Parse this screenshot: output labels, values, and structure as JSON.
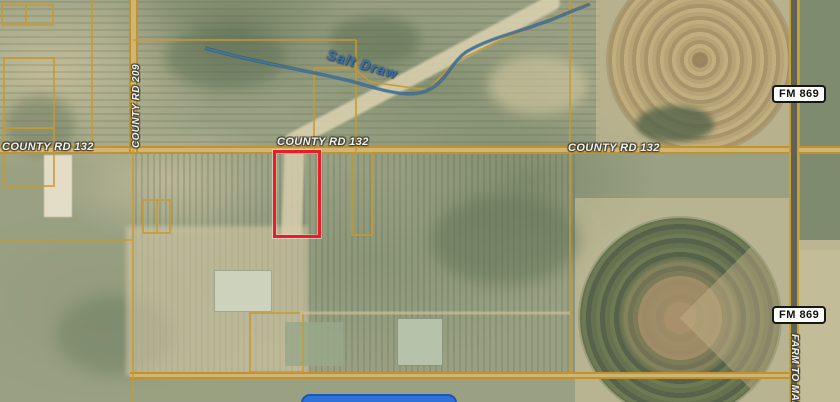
{
  "map": {
    "roads": {
      "county_rd_132": {
        "label": "COUNTY RD 132"
      },
      "county_rd_209": {
        "label": "COUNTY RD 209"
      },
      "farm_to_market": {
        "label": "FARM TO MAR"
      },
      "fm_869": {
        "shield_label": "FM 869"
      }
    },
    "water": {
      "salt_draw_label": "Salt Draw"
    },
    "highlight": {
      "description": "highlighted-parcel-outline",
      "color": "#ec1b24"
    },
    "colors": {
      "parcel_line": "#c9992f",
      "road_fill": "#cdb678",
      "stream": "#3f74a6",
      "water_label": "#3a6ea8",
      "shield_background": "#fdfdfa",
      "shield_border": "#161616",
      "blue_bar": "#2e71d8"
    }
  }
}
